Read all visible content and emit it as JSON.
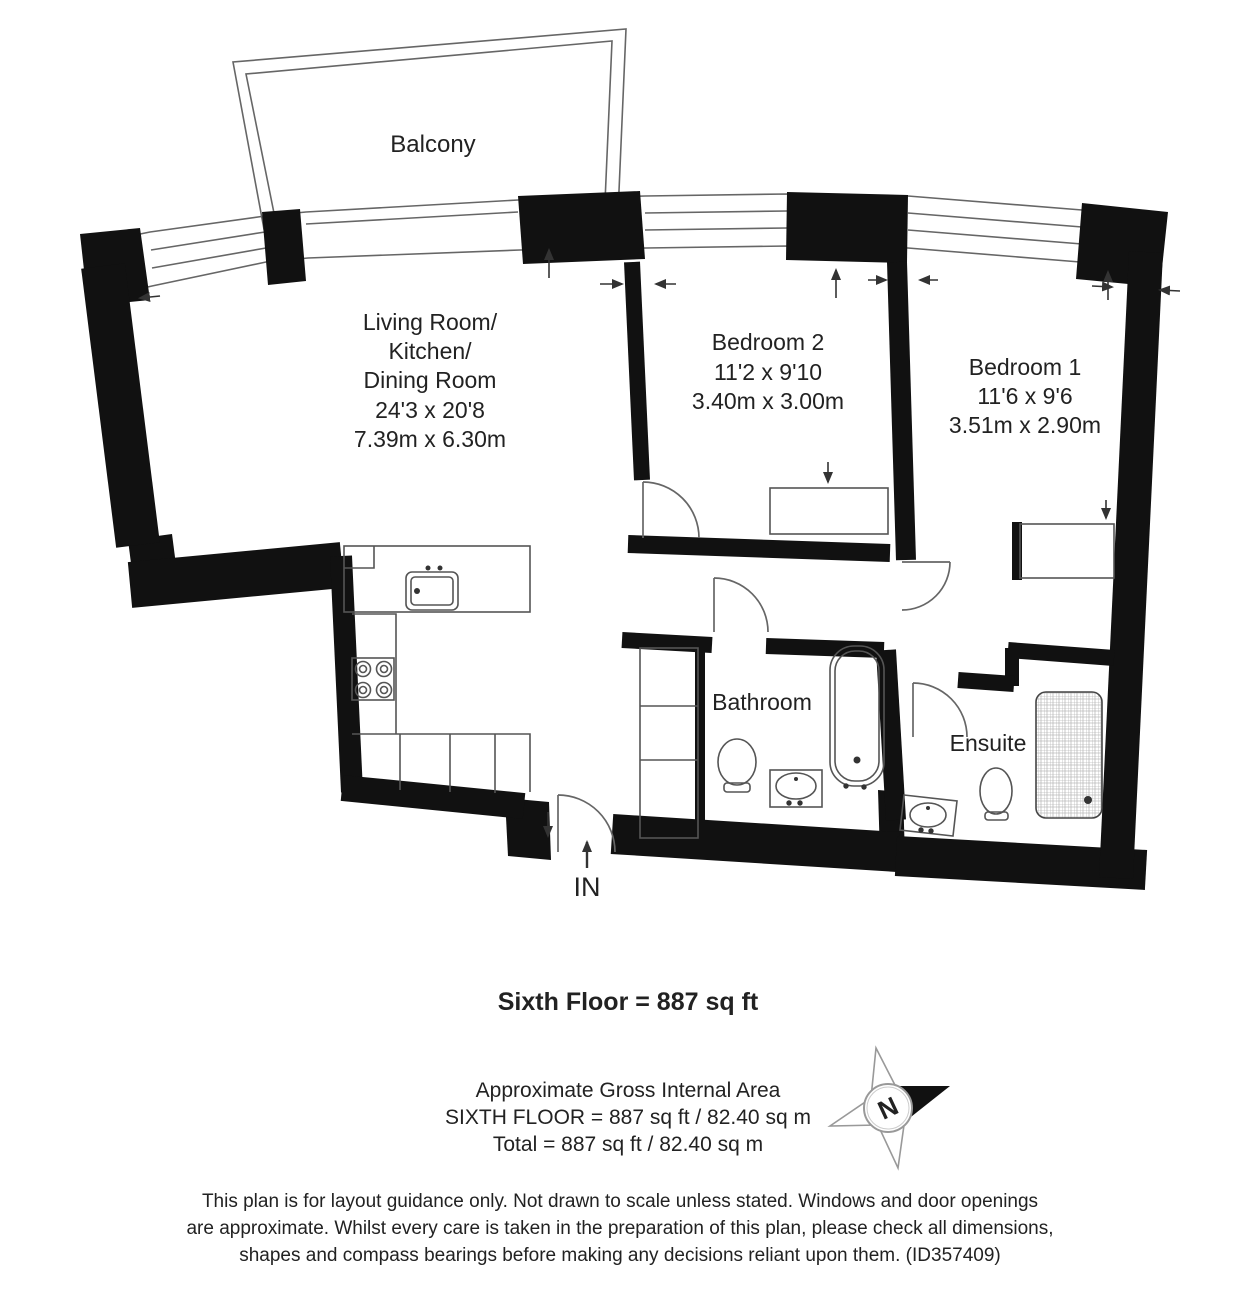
{
  "plan": {
    "balcony": {
      "label": "Balcony"
    },
    "living_room": {
      "name_line1": "Living Room/",
      "name_line2": "Kitchen/",
      "name_line3": "Dining Room",
      "dims_imperial": "24'3 x 20'8",
      "dims_metric": "7.39m x 6.30m"
    },
    "bedroom_2": {
      "name": "Bedroom 2",
      "dims_imperial": "11'2 x 9'10",
      "dims_metric": "3.40m x 3.00m"
    },
    "bedroom_1": {
      "name": "Bedroom 1",
      "dims_imperial": "11'6 x 9'6",
      "dims_metric": "3.51m x 2.90m"
    },
    "bathroom": {
      "label": "Bathroom"
    },
    "ensuite": {
      "label": "Ensuite"
    },
    "entrance": {
      "label": "IN"
    }
  },
  "compass": {
    "north_label": "N"
  },
  "summary": {
    "floor_title": "Sixth Floor = 887 sq ft",
    "area_heading": "Approximate Gross Internal Area",
    "area_sixth_floor": "SIXTH FLOOR = 887 sq ft / 82.40 sq m",
    "area_total": "Total = 887 sq ft / 82.40 sq m"
  },
  "disclaimer": {
    "line1": "This plan is for layout guidance only. Not drawn to scale unless stated. Windows and door openings",
    "line2": "are approximate. Whilst every care is taken in the preparation of this plan, please check all dimensions,",
    "line3": "shapes and compass bearings before making any decisions reliant upon them. (ID357409)"
  },
  "colors": {
    "wall": "#111111",
    "thin_line": "#555555",
    "text": "#222222",
    "background": "#ffffff"
  }
}
